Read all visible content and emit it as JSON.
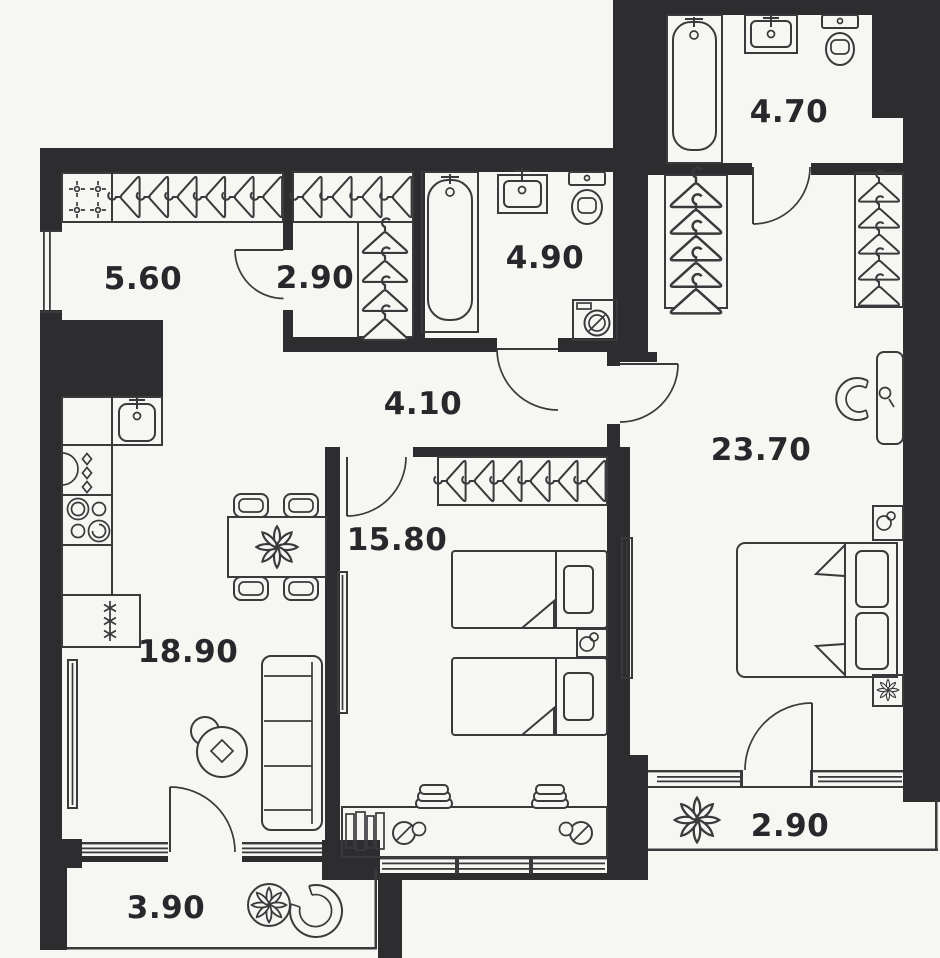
{
  "page": {
    "title": "Two-bedroom apartment floor plan"
  },
  "colors": {
    "background": "#f6f6f3",
    "wall": "#2d2d2f",
    "line": "#3a3a3c",
    "label": "#28282c"
  },
  "rooms": [
    {
      "id": "hallway",
      "area": "5.60"
    },
    {
      "id": "wardrobe",
      "area": "2.90"
    },
    {
      "id": "bathroom",
      "area": "4.90"
    },
    {
      "id": "bathroom-2",
      "area": "4.70"
    },
    {
      "id": "corridor",
      "area": "4.10"
    },
    {
      "id": "bedroom",
      "area": "15.80"
    },
    {
      "id": "master-bedroom",
      "area": "23.70"
    },
    {
      "id": "kitchen-living-room",
      "area": "18.90"
    },
    {
      "id": "balcony",
      "area": "3.90"
    },
    {
      "id": "loggia",
      "area": "2.90"
    }
  ],
  "icons": {
    "hanger": "hanger-icon",
    "coat-hook": "cross-hook-icon",
    "fridge": "snowflake-icon",
    "oven": "diamond-icon",
    "stove": "burners-icon",
    "plant": "flower-icon",
    "lamp": "table-lamp-icon",
    "washing-machine": "washer-drum-icon"
  }
}
